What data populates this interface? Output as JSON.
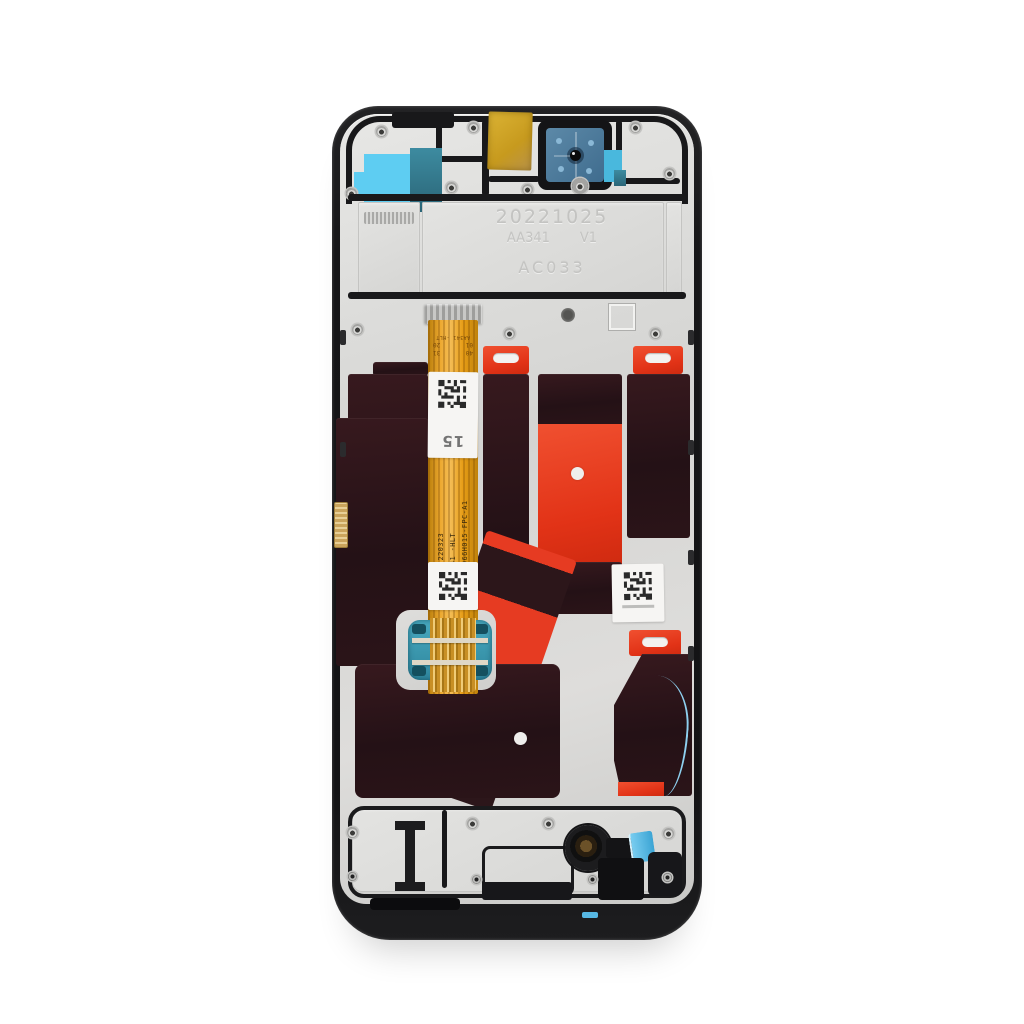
{
  "product_photo": {
    "frame_engravings": {
      "date_code": "20221025",
      "model_code": "AA341",
      "version": "V1",
      "part_code": "AC033"
    },
    "flex_cable": {
      "part_number": "HTF066H015-FPC-A1",
      "model_line": "AA341 -HLT",
      "batch_code": "JBE 220323",
      "top_marking": "AA341 -HLT",
      "pin_labels": [
        "01",
        "20",
        "40",
        "31"
      ],
      "sticker_number": "15"
    },
    "colors": {
      "frame_black": "#17171a",
      "chassis_metal": "#d9d8d6",
      "adhesive_panel": "#2b1518",
      "sticker_red": "#e63b22",
      "flex_orange": "#e9a01d",
      "connector_teal": "#3b9cb4",
      "film_cyan": "#56c5ee",
      "kapton_yellow": "#d2a72a",
      "camera_film_blue": "#4f7da0"
    }
  }
}
